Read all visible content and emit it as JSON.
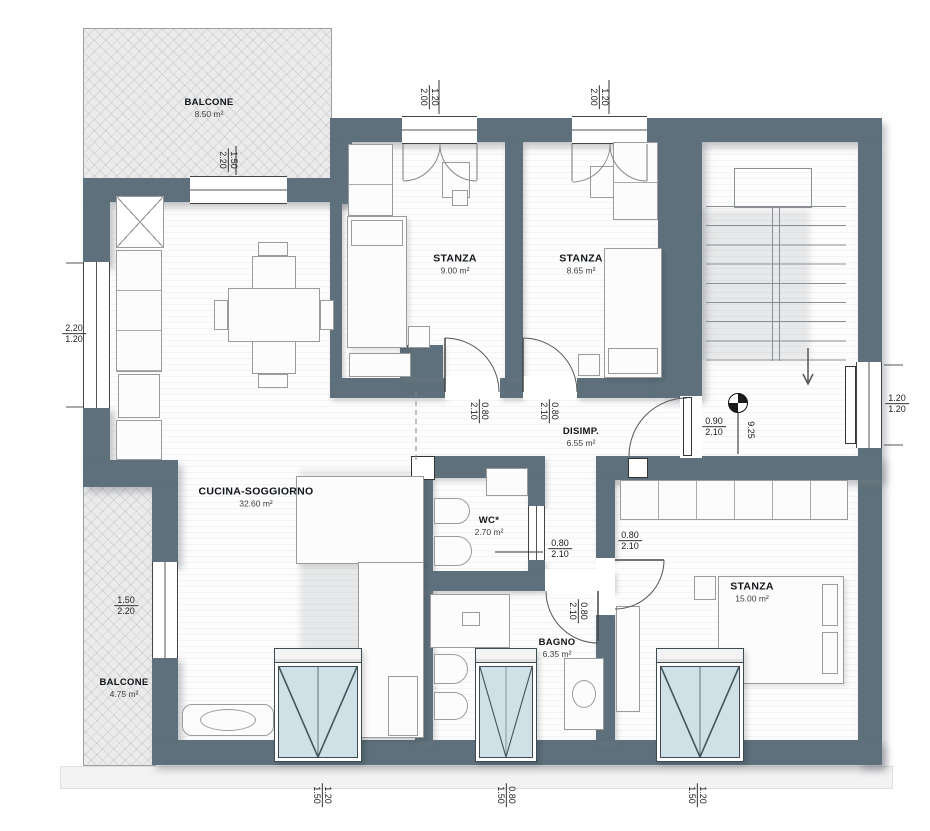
{
  "plan": {
    "rooms": [
      {
        "id": "balcone-top",
        "name": "BALCONE",
        "area": "8.50 m²"
      },
      {
        "id": "stanza-1",
        "name": "STANZA",
        "area": "9.00 m²"
      },
      {
        "id": "stanza-2",
        "name": "STANZA",
        "area": "8.65 m²"
      },
      {
        "id": "disimpegno",
        "name": "DISIMP.",
        "area": "6.55 m²"
      },
      {
        "id": "wc",
        "name": "WC*",
        "area": "2.70 m²"
      },
      {
        "id": "cucina-soggiorno",
        "name": "CUCINA-SOGGIORNO",
        "area": "32.60 m²"
      },
      {
        "id": "bagno",
        "name": "BAGNO",
        "area": "6.35 m²"
      },
      {
        "id": "stanza-3",
        "name": "STANZA",
        "area": "15.00 m²"
      },
      {
        "id": "balcone-bottom",
        "name": "BALCONE",
        "area": "4.75 m²"
      }
    ],
    "dims": {
      "top_window_1": {
        "w": "1.20",
        "h": "2.00"
      },
      "top_window_2": {
        "w": "1.20",
        "h": "2.00"
      },
      "top_balcony_door": {
        "w": "1.50",
        "h": "2.20"
      },
      "left_window": {
        "w": "2.20",
        "h": "1.20"
      },
      "door_stanza_1": {
        "w": "0.80",
        "h": "2.10"
      },
      "door_stanza_2": {
        "w": "0.80",
        "h": "2.10"
      },
      "entry_door": {
        "w": "0.90",
        "h": "2.10"
      },
      "right_window": {
        "w": "1.20",
        "h": "1.20"
      },
      "door_wc": {
        "w": "0.80",
        "h": "2.10"
      },
      "door_stanza_3": {
        "w": "0.80",
        "h": "2.10"
      },
      "door_bagno": {
        "w": "0.80",
        "h": "2.10"
      },
      "left_balcony_door": {
        "w": "1.50",
        "h": "2.20"
      },
      "bottom_window_1": {
        "w": "1.20",
        "h": "1.50"
      },
      "bottom_window_2": {
        "w": "0.80",
        "h": "1.50"
      },
      "bottom_window_3": {
        "w": "1.20",
        "h": "1.50"
      }
    },
    "level_mark": "9.25",
    "colors": {
      "wall": "#5d707b",
      "glass": "#cfe0e6",
      "balcony_hatch": "#ebebeb"
    }
  }
}
